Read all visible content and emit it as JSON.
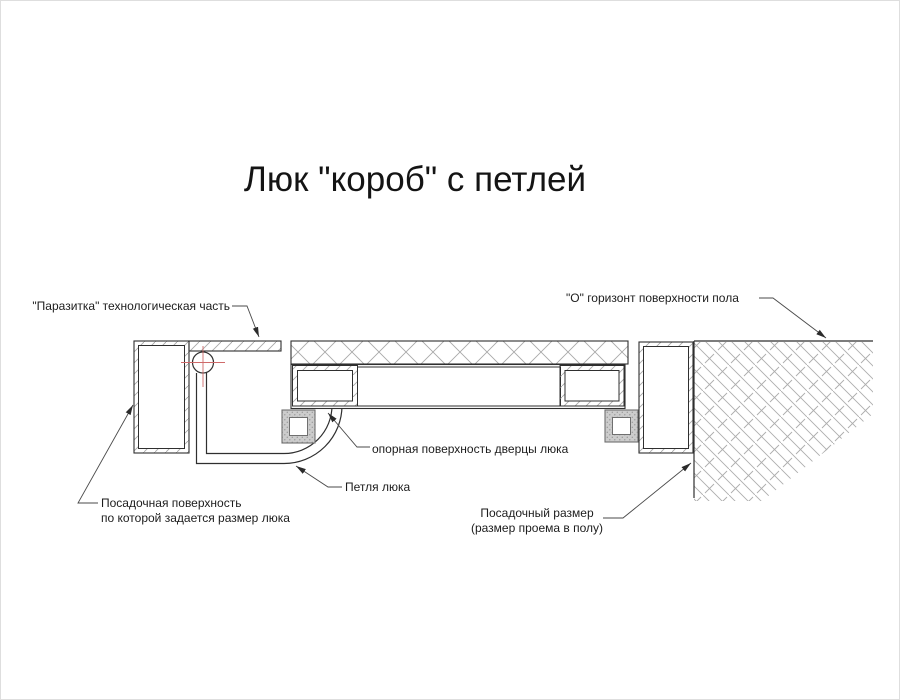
{
  "title": "Люк \"короб\" с петлей",
  "labels": {
    "parasitka": "\"Паразитка\" технологическая часть",
    "horizon": "\"О\" горизонт поверхности пола",
    "door_support": "опорная поверхность дверцы люка",
    "hinge": "Петля люка",
    "seat_surface_1": "Посадочная поверхность",
    "seat_surface_2": "по которой задается размер люка",
    "seat_size_1": "Посадочный размер",
    "seat_size_2": "(размер проема в полу)"
  },
  "colors": {
    "line": "#2f2f2f",
    "hatch": "#a8a8a8",
    "leader": "#4a4a4a",
    "center_mark_red": "#cf6a6a",
    "mount_plate_gray": "#cccccc",
    "background": "#ffffff"
  }
}
